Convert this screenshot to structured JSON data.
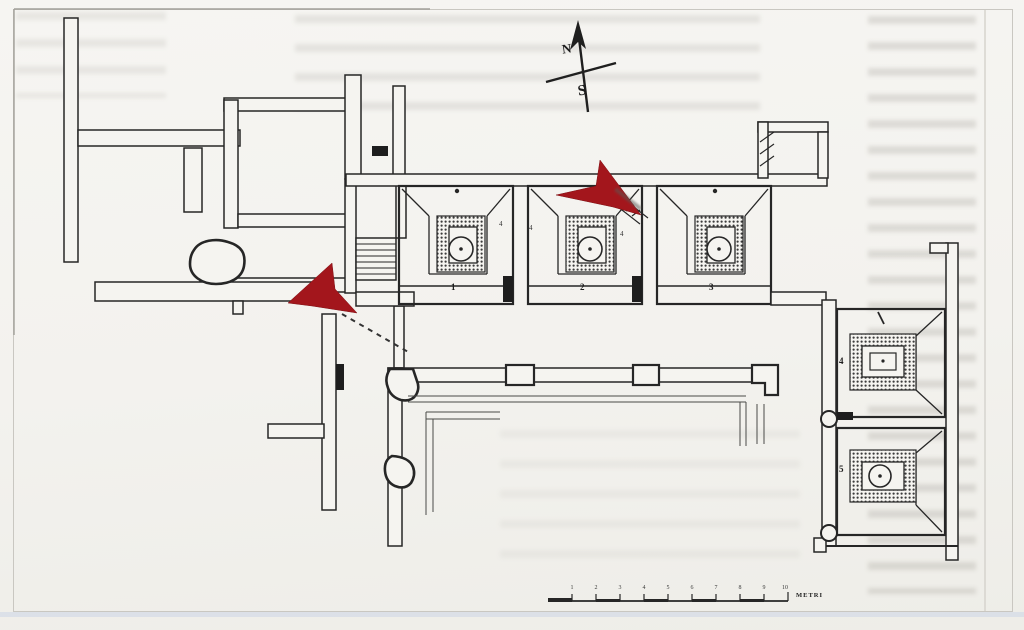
{
  "plan": {
    "room_labels": [
      "1",
      "2",
      "3",
      "4",
      "5"
    ],
    "door_marks": [
      "4",
      "4",
      "4"
    ],
    "compass": {
      "north": "N",
      "south": "S"
    },
    "scale_bar": {
      "unit_label": "METRI",
      "tick_numbers": [
        "1",
        "2",
        "3",
        "4",
        "5",
        "6",
        "7",
        "8",
        "9",
        "10"
      ]
    },
    "colors": {
      "paper": "#f4f3ef",
      "ink": "#262626",
      "arrow_red": "#a3161c",
      "page_edge_blue": "#ccd5e6"
    }
  }
}
